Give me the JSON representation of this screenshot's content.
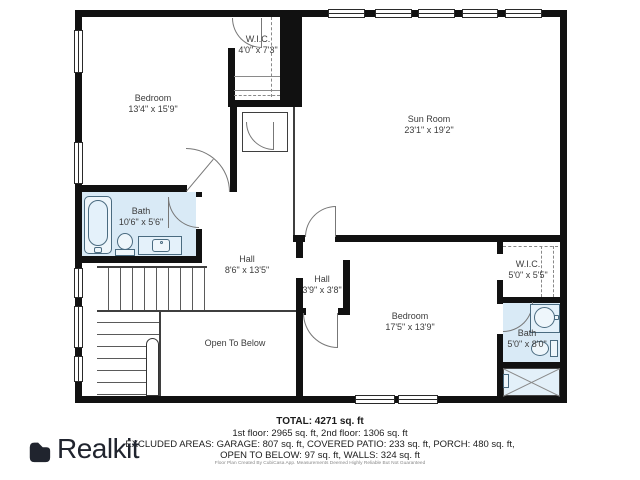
{
  "branding": {
    "logo_text": "Realkit",
    "logo_icon": "realkit-bag-icon"
  },
  "rooms": [
    {
      "id": "bedroom-1",
      "name": "Bedroom",
      "dims": "13'4\" x 15'9\""
    },
    {
      "id": "wic-1",
      "name": "W.I.C.",
      "dims": "4'0\" x 7'3\""
    },
    {
      "id": "sun-room",
      "name": "Sun Room",
      "dims": "23'1\" x 19'2\""
    },
    {
      "id": "bath-1",
      "name": "Bath",
      "dims": "10'6\" x 5'6\""
    },
    {
      "id": "hall-1",
      "name": "Hall",
      "dims": "8'6\" x 13'5\""
    },
    {
      "id": "hall-2",
      "name": "Hall",
      "dims": "3'9\" x 3'8\""
    },
    {
      "id": "bedroom-2",
      "name": "Bedroom",
      "dims": "17'5\" x 13'9\""
    },
    {
      "id": "wic-2",
      "name": "W.I.C.",
      "dims": "5'0\" x 5'5\""
    },
    {
      "id": "bath-2",
      "name": "Bath",
      "dims": "5'0\" x 8'0\""
    },
    {
      "id": "open-to-below",
      "name": "Open To Below",
      "dims": ""
    }
  ],
  "summary": {
    "total": "TOTAL: 4271 sq. ft",
    "floors": "1st floor: 2965 sq. ft, 2nd floor: 1306 sq. ft",
    "excluded_1": "EXCLUDED AREAS: GARAGE: 807 sq. ft, COVERED PATIO: 233 sq. ft, PORCH: 480 sq. ft,",
    "excluded_2": "OPEN TO BELOW: 97 sq. ft, WALLS: 324 sq. ft",
    "disclaimer": "Floor Plan Created By CubiCasa App. Measurements Deemed Highly Reliable But Not Guaranteed"
  },
  "colors": {
    "wall": "#111111",
    "bath_fill": "#d9eaf6",
    "fixture_stroke": "#4a6b80",
    "label_text": "#3c3c3c",
    "logo_color": "#20242e"
  }
}
